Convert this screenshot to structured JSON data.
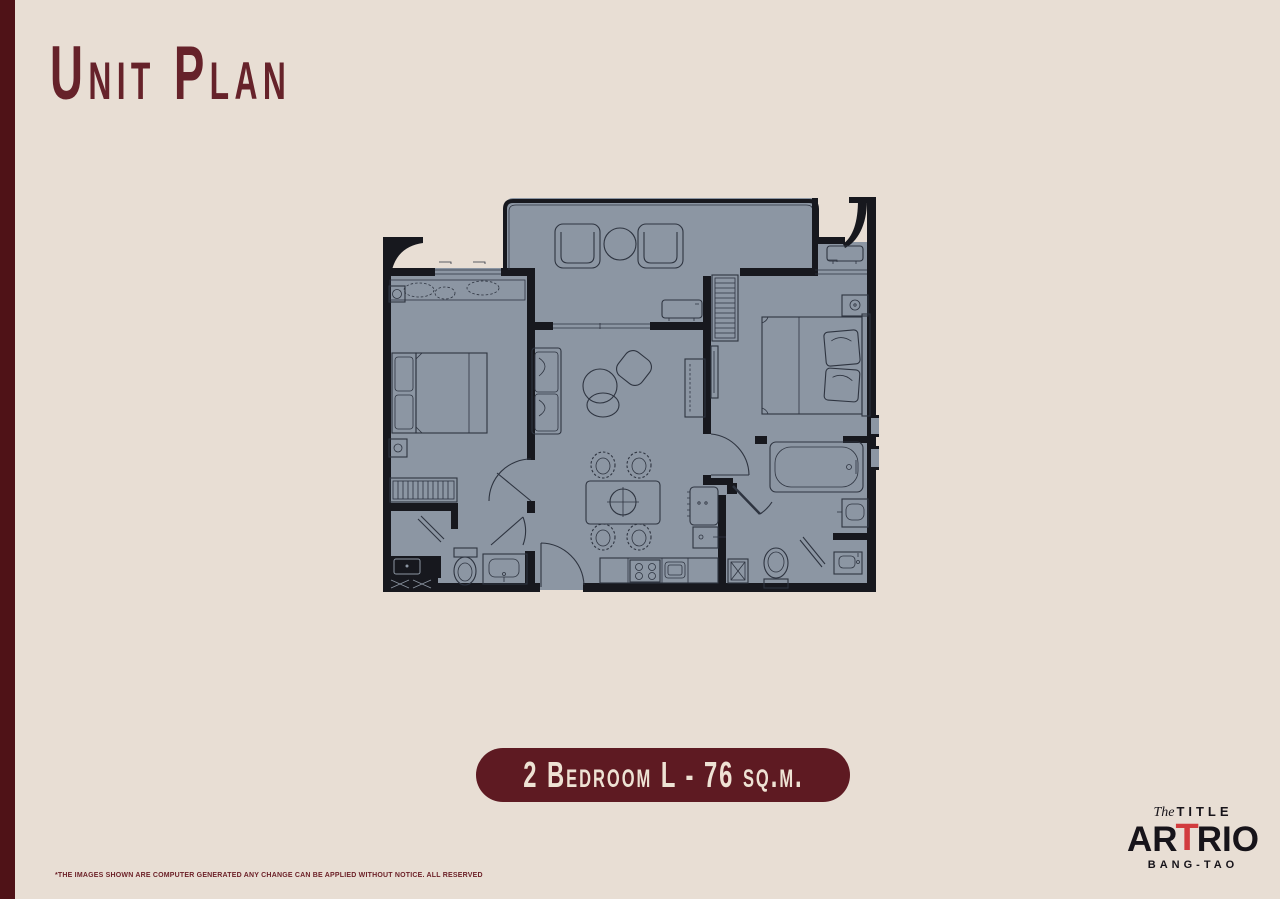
{
  "page": {
    "background": "#e8ded4",
    "left_stripe_color": "#4f1217"
  },
  "header": {
    "title": "Unit Plan"
  },
  "unit_badge": {
    "label": "2 Bedroom L - 76 sq.m.",
    "background": "#5e1a22",
    "text_color": "#eee2d4"
  },
  "floor_plan": {
    "floor_color": "#8c96a3",
    "wall_color": "#17181e",
    "line_color": "#2e3440",
    "rooms": [
      "balcony",
      "bedroom-1",
      "living-dining",
      "kitchen",
      "bedroom-2",
      "bathroom-1",
      "bathroom-2",
      "entrance"
    ]
  },
  "brand_logo": {
    "script_prefix": "The",
    "brand_top": "TITLE",
    "brand_left": "AR",
    "brand_accent": "T",
    "brand_right": "RIO",
    "location": "BANG-TAO",
    "accent_color": "#d23c3e"
  },
  "disclaimer": "*THE IMAGES SHOWN ARE COMPUTER GENERATED ANY CHANGE CAN BE APPLIED WITHOUT NOTICE. ALL RESERVED"
}
